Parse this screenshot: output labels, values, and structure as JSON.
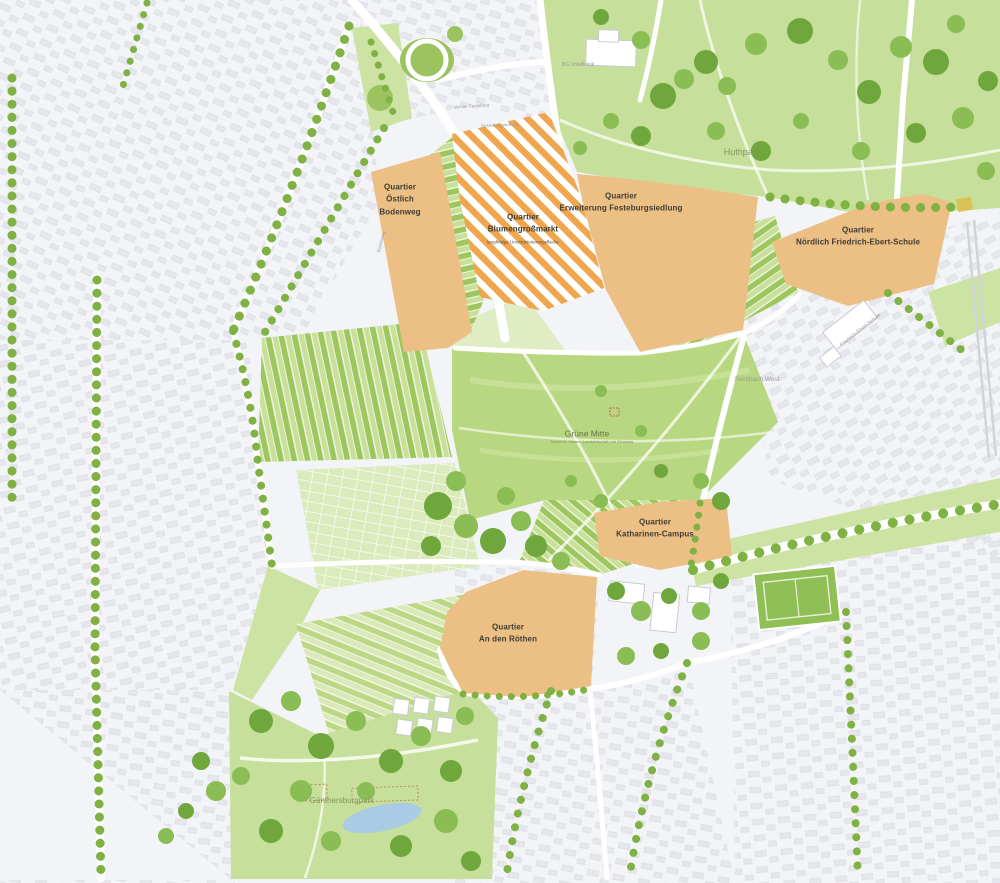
{
  "quartiers": {
    "oestlich_bodenweg": {
      "text": "Quartier\nÖstlich\nBodenweg"
    },
    "blumengrossmarkt": {
      "text": "Quartier\nBlumengroßmarkt",
      "subtitle": "langfristige Umstrukturierungsfläche"
    },
    "erweiterung_festeburgsiedlung": {
      "text": "Quartier\nErweiterung Festeburgsiedlung"
    },
    "noerdlich_friedrich_ebert_schule": {
      "text": "Quartier\nNördlich Friedrich-Ebert-Schule"
    },
    "katharinen_campus": {
      "text": "Quartier\nKatharinen-Campus"
    },
    "an_den_roethen": {
      "text": "Quartier\nAn den Röthen"
    }
  },
  "places": {
    "huthpark": "Huthpark",
    "gruene_mitte": "Grüne Mitte",
    "gruene_mitte_subtitle": "Raum für Gärten, Landwirtschaft und Erholung",
    "guenthersburgpark": "Günthersburgpark",
    "seckbach_west": "Seckbach West",
    "bg_unfallklinik": "BG Unfallklinik",
    "an_der_festeburg": "An der Festeburg",
    "festeburgsiedlung": "Festeburgsiedlung",
    "friedrich_ebert_schule": "Friedrich-Ebert-Schule",
    "bodenweg": "Bodenweg"
  },
  "colors": {
    "quartier_fill": "#ecbf85",
    "quartier_hatch_orange": "#efa64e",
    "park_green": "#c6df9b",
    "field_green_dark": "#9dc75e",
    "field_green_light": "#c8e09a",
    "meadow_green": "#b7d880",
    "tree_green": "#8abd54",
    "tree_green_dark": "#6fa73c",
    "water_blue": "#a9cbe3",
    "city_background": "#f3f4f7",
    "building_gray": "#e4e6eb",
    "road_white": "#ffffff",
    "quartier_label_color": "#3e3c33",
    "park_label_color": "#84955c",
    "city_label_color": "#9b9b9b"
  }
}
